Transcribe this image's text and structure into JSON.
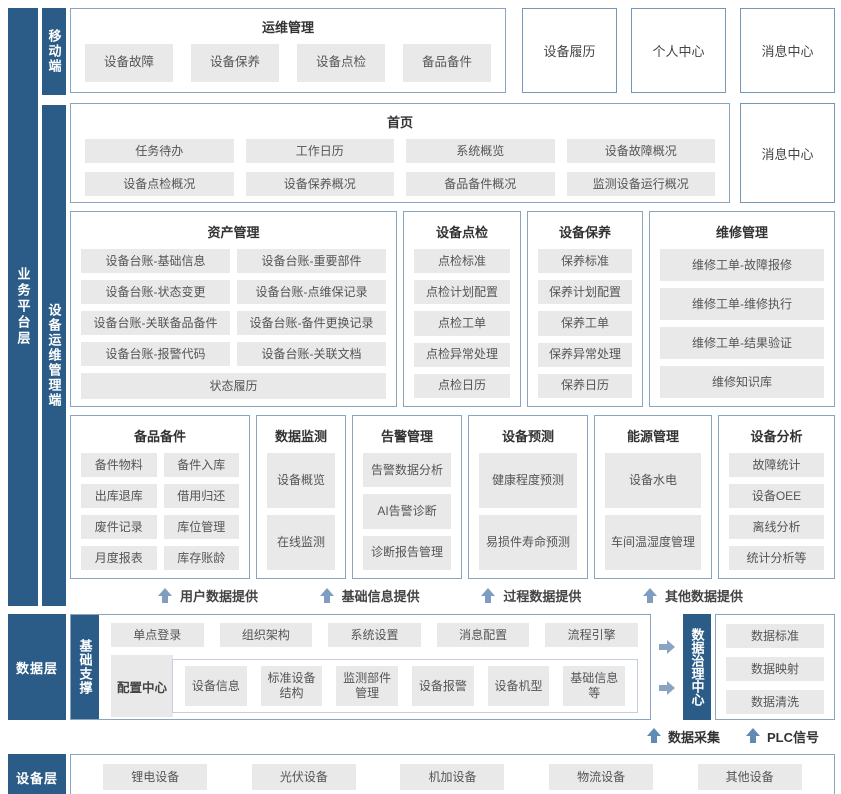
{
  "colors": {
    "bar_blue": "#2b5c88",
    "box_border": "#8aa5c0",
    "button_bg": "#e9e9e9",
    "button_text": "#595959",
    "title_text": "#333333",
    "arrow_steel": "#7e9dc0",
    "arrow_dark": "#5e8ab4"
  },
  "labels": {
    "business_platform_layer": "业务平台层",
    "mobile_client": "移动端",
    "device_ops_client": "设备运维管理端",
    "data_layer": "数据层",
    "base_support": "基础支撑",
    "data_governance_center": "数据治理中心",
    "device_layer": "设备层"
  },
  "mobile_row": {
    "ops_box": {
      "title": "运维管理",
      "items": [
        "设备故障",
        "设备保养",
        "设备点检",
        "备品备件"
      ]
    },
    "side_boxes": [
      "设备履历",
      "个人中心",
      "消息中心"
    ]
  },
  "home_row": {
    "home_box": {
      "title": "首页",
      "items": [
        "任务待办",
        "工作日历",
        "系统概览",
        "设备故障概况",
        "设备点检概况",
        "设备保养概况",
        "备品备件概况",
        "监测设备运行概况"
      ]
    },
    "side_box": "消息中心"
  },
  "modules_row1": [
    {
      "title": "资产管理",
      "items": [
        "设备台账-基础信息",
        "设备台账-重要部件",
        "设备台账-状态变更",
        "设备台账-点维保记录",
        "设备台账-关联备品备件",
        "设备台账-备件更换记录",
        "设备台账-报警代码",
        "设备台账-关联文档"
      ],
      "footer": "状态履历"
    },
    {
      "title": "设备点检",
      "items": [
        "点检标准",
        "点检计划配置",
        "点检工单",
        "点检异常处理",
        "点检日历"
      ]
    },
    {
      "title": "设备保养",
      "items": [
        "保养标准",
        "保养计划配置",
        "保养工单",
        "保养异常处理",
        "保养日历"
      ]
    },
    {
      "title": "维修管理",
      "items": [
        "维修工单-故障报修",
        "维修工单-维修执行",
        "维修工单-结果验证",
        "维修知识库"
      ]
    }
  ],
  "modules_row2": [
    {
      "title": "备品备件",
      "items": [
        "备件物料",
        "备件入库",
        "出库退库",
        "借用归还",
        "废件记录",
        "库位管理",
        "月度报表",
        "库存账龄"
      ]
    },
    {
      "title": "数据监测",
      "items": [
        "设备概览",
        "在线监测"
      ]
    },
    {
      "title": "告警管理",
      "items": [
        "告警数据分析",
        "AI告警诊断",
        "诊断报告管理"
      ]
    },
    {
      "title": "设备预测",
      "items": [
        "健康程度预测",
        "易损件寿命预测"
      ]
    },
    {
      "title": "能源管理",
      "items": [
        "设备水电",
        "车间温湿度管理"
      ]
    },
    {
      "title": "设备分析",
      "items": [
        "故障统计",
        "设备OEE",
        "离线分析",
        "统计分析等"
      ]
    }
  ],
  "feed_arrows": [
    "用户数据提供",
    "基础信息提供",
    "过程数据提供",
    "其他数据提供"
  ],
  "data_layer": {
    "top_items": [
      "单点登录",
      "组织架构",
      "系统设置",
      "消息配置",
      "流程引擎"
    ],
    "config_center": "配置中心",
    "config_items": [
      "设备信息",
      "标准设备结构",
      "监测部件管理",
      "设备报警",
      "设备机型",
      "基础信息等"
    ],
    "governance_items": [
      "数据标准",
      "数据映射",
      "数据清洗"
    ],
    "collect_arrows": [
      "数据采集",
      "PLC信号"
    ]
  },
  "device_layer_items": [
    "锂电设备",
    "光伏设备",
    "机加设备",
    "物流设备",
    "其他设备"
  ]
}
